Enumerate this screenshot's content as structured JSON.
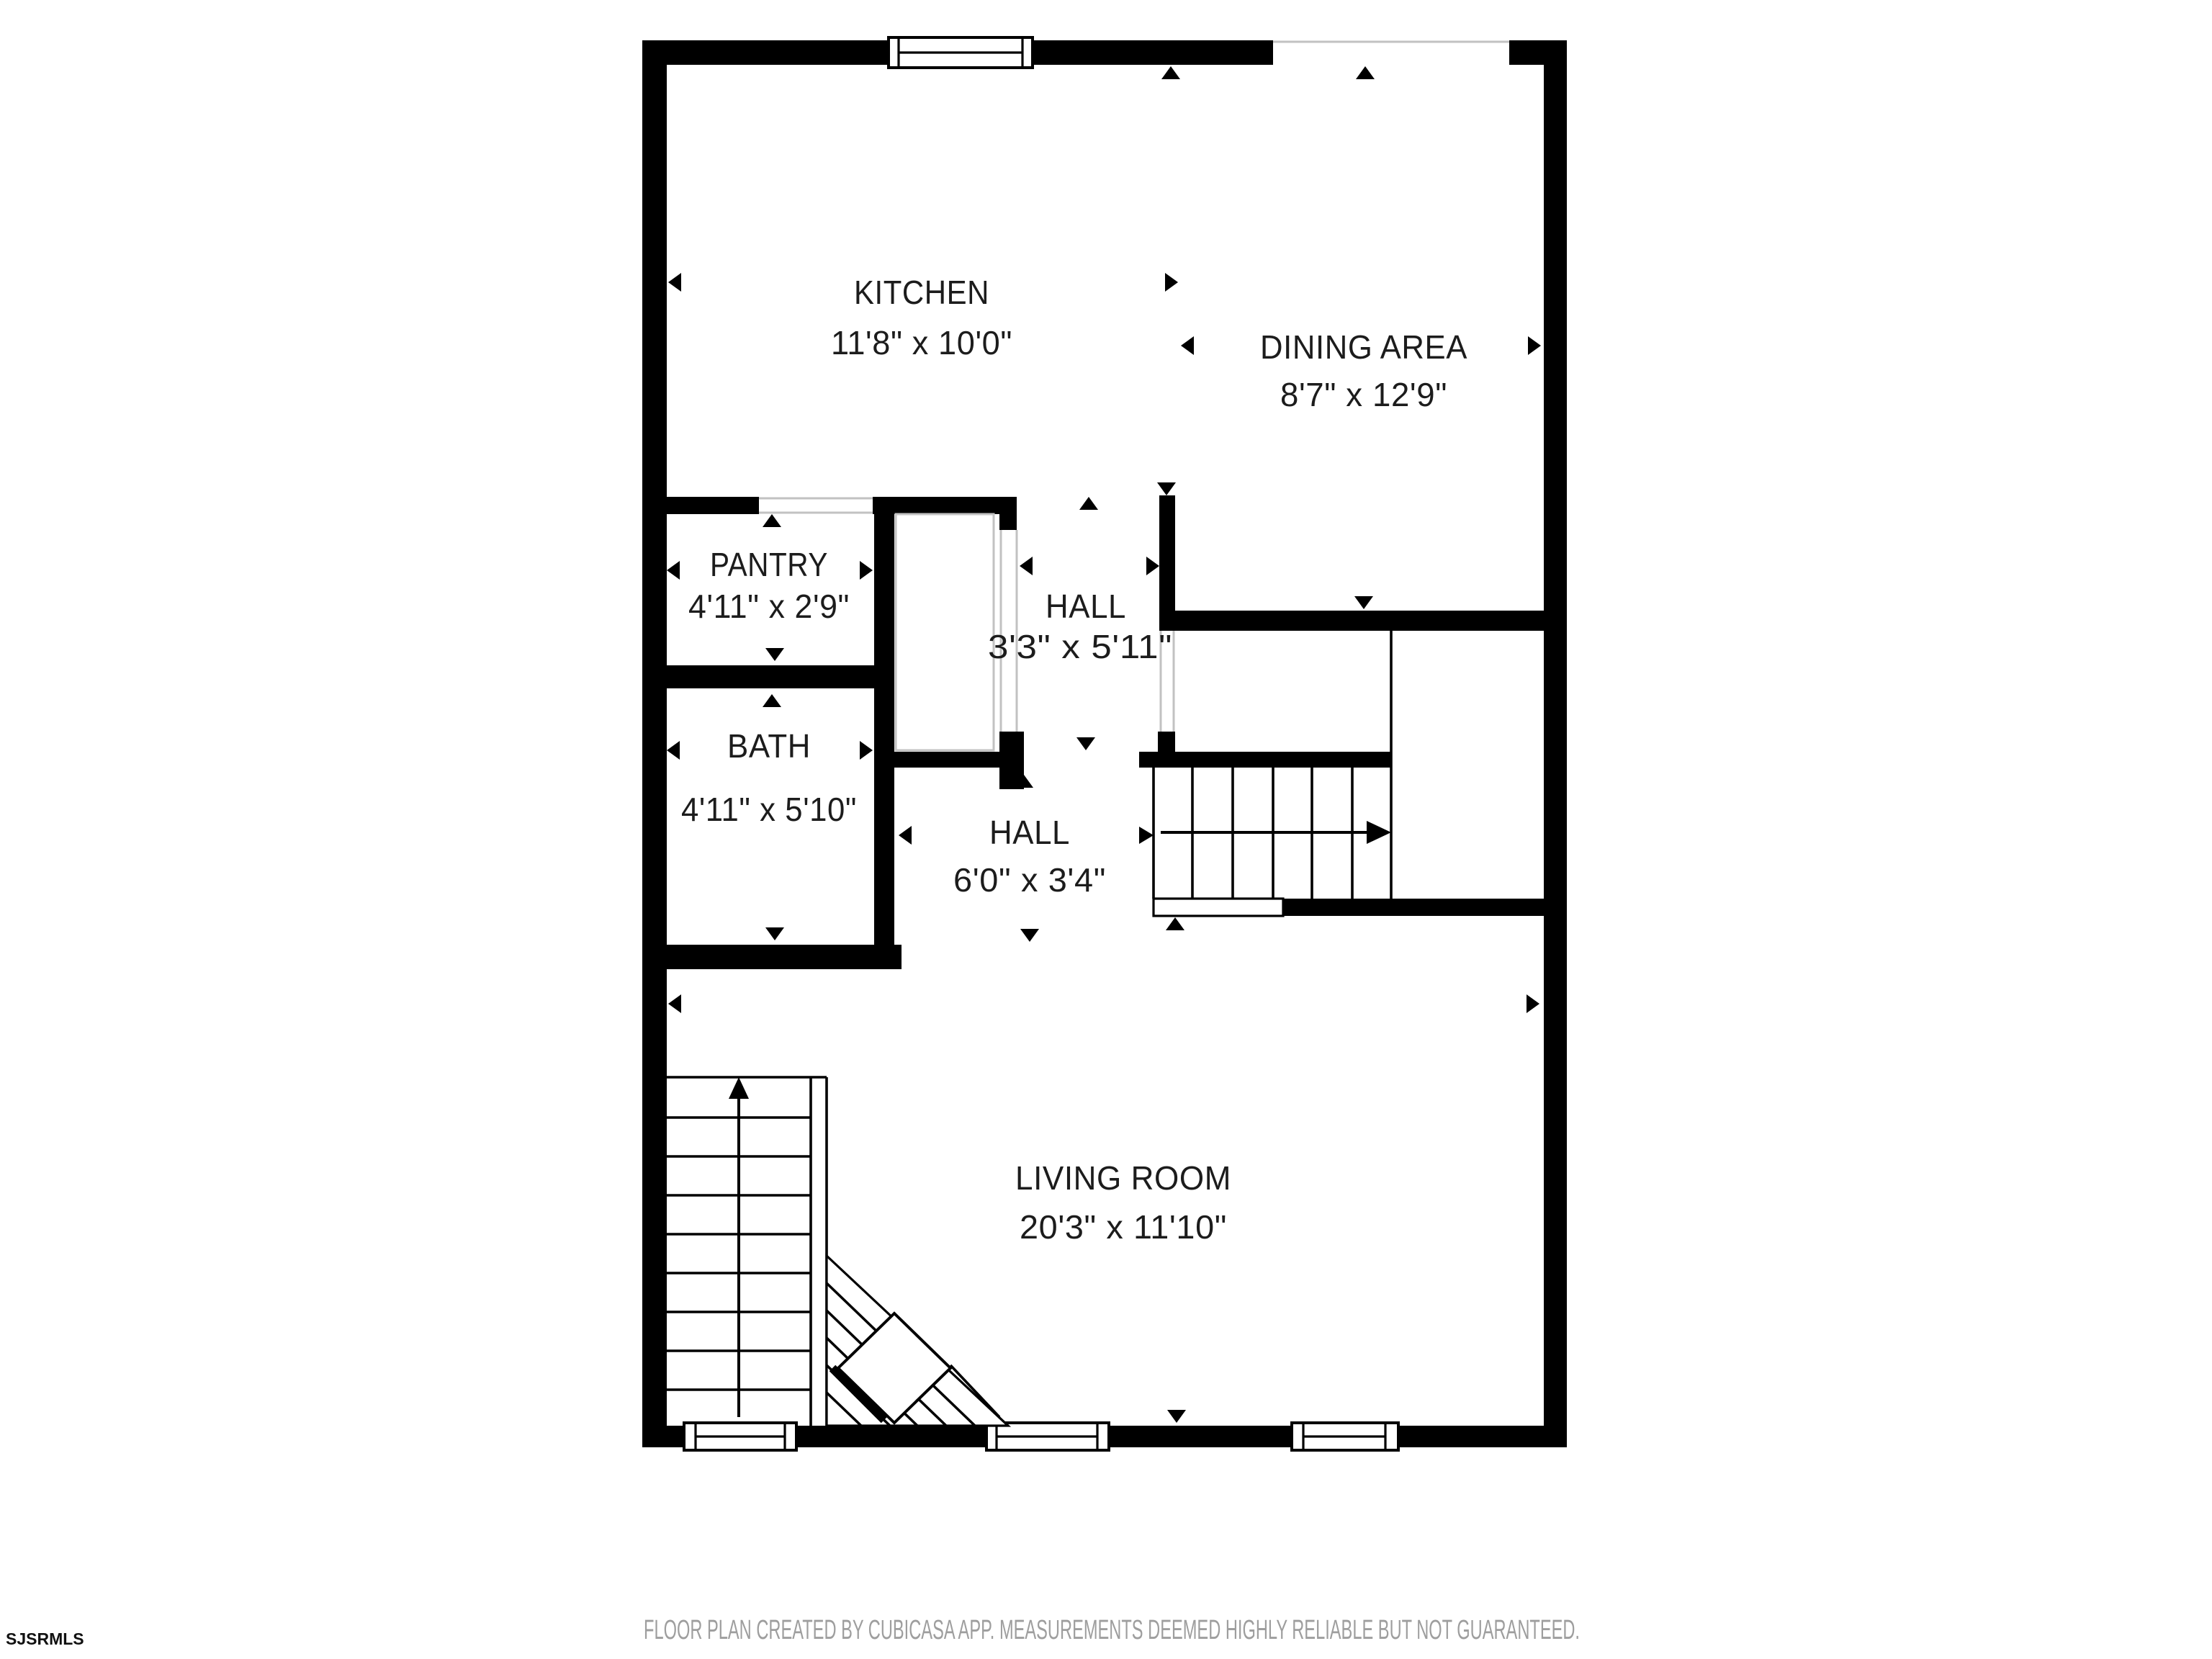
{
  "floor_plan": {
    "rooms": [
      {
        "id": "kitchen",
        "name": "KITCHEN",
        "dims": "11'8\" x 10'0\""
      },
      {
        "id": "dining-area",
        "name": "DINING AREA",
        "dims": "8'7\" x 12'9\""
      },
      {
        "id": "pantry",
        "name": "PANTRY",
        "dims": "4'11\" x 2'9\""
      },
      {
        "id": "hall-upper",
        "name": "HALL",
        "dims": "3'3\" x 5'11\""
      },
      {
        "id": "bath",
        "name": "BATH",
        "dims": "4'11\" x 5'10\""
      },
      {
        "id": "hall-lower",
        "name": "HALL",
        "dims": "6'0\" x 3'4\""
      },
      {
        "id": "living-room",
        "name": "LIVING ROOM",
        "dims": "20'3\" x 11'10\""
      }
    ],
    "colors": {
      "wall": "#000000",
      "background": "#ffffff",
      "label_text": "#1c1c1c"
    }
  },
  "footer": {
    "disclaimer": "FLOOR PLAN CREATED BY CUBICASA APP. MEASUREMENTS DEEMED HIGHLY RELIABLE BUT NOT GUARANTEED.",
    "color": "#9e9e9e"
  },
  "watermark": {
    "label": "SJSRMLS"
  }
}
